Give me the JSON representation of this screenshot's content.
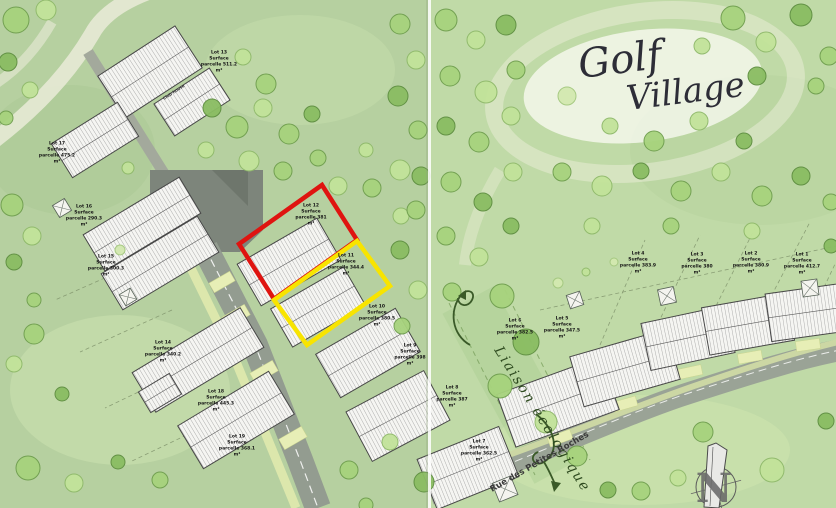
{
  "title": {
    "word1": "Golf",
    "word2": "Village"
  },
  "labels": {
    "street": "Rue des Petites Roches",
    "eco_corridor": "Liaison écologique",
    "compass": "N",
    "club": "Club house"
  },
  "highlights": {
    "red": "#df1410",
    "yellow": "#f8e400"
  },
  "lots": [
    {
      "id": "lot-12",
      "x": 311,
      "y": 215,
      "highlight": "red",
      "label": "Lot 12\nSurface\nparcelle 381\nm²"
    },
    {
      "id": "lot-11",
      "x": 346,
      "y": 265,
      "highlight": "yellow",
      "label": "Lot 11\nSurface\nparcelle 344.4\nm²"
    },
    {
      "id": "lot-10",
      "x": 377,
      "y": 316,
      "highlight": "none",
      "label": "Lot 10\nSurface\nparcelle 380.5\nm²"
    },
    {
      "id": "lot-13",
      "x": 219,
      "y": 62,
      "highlight": "none",
      "label": "Lot 13\nSurface\nparcelle 511.2\nm²"
    },
    {
      "id": "lot-17",
      "x": 57,
      "y": 153,
      "highlight": "none",
      "label": "Lot 17\nSurface\nparcelle 475.2\nm²"
    },
    {
      "id": "lot-16",
      "x": 84,
      "y": 216,
      "highlight": "none",
      "label": "Lot 16\nSurface\nparcelle 290.3\nm²"
    },
    {
      "id": "lot-15",
      "x": 106,
      "y": 266,
      "highlight": "none",
      "label": "Lot 15\nSurface\nparcelle 300.3\nm²"
    },
    {
      "id": "lot-14",
      "x": 163,
      "y": 352,
      "highlight": "none",
      "label": "Lot 14\nSurface\nparcelle 340.2\nm²"
    },
    {
      "id": "lot-18",
      "x": 216,
      "y": 401,
      "highlight": "none",
      "label": "Lot 18\nSurface\nparcelle 445.3\nm²"
    },
    {
      "id": "lot-19",
      "x": 237,
      "y": 446,
      "highlight": "none",
      "label": "Lot 19\nSurface\nparcelle 368.1\nm²"
    },
    {
      "id": "lot-9",
      "x": 410,
      "y": 355,
      "highlight": "none",
      "label": "Lot 9\nSurface\nparcelle 398\nm²"
    },
    {
      "id": "lot-8",
      "x": 452,
      "y": 397,
      "highlight": "none",
      "label": "Lot 8\nSurface\nparcelle 387\nm²"
    },
    {
      "id": "lot-7",
      "x": 479,
      "y": 451,
      "highlight": "none",
      "label": "Lot 7\nSurface\nparcelle 362.5\nm²"
    },
    {
      "id": "lot-6",
      "x": 515,
      "y": 330,
      "highlight": "none",
      "label": "Lot 6\nSurface\nparcelle 382.5\nm²"
    },
    {
      "id": "lot-5",
      "x": 562,
      "y": 328,
      "highlight": "none",
      "label": "Lot 5\nSurface\nparcelle 347.5\nm²"
    },
    {
      "id": "lot-4",
      "x": 638,
      "y": 263,
      "highlight": "none",
      "label": "Lot 4\nSurface\nparcelle 383.9\nm²"
    },
    {
      "id": "lot-3",
      "x": 697,
      "y": 264,
      "highlight": "none",
      "label": "Lot 3\nSurface\nparcelle 380\nm²"
    },
    {
      "id": "lot-2",
      "x": 751,
      "y": 263,
      "highlight": "none",
      "label": "Lot 2\nSurface\nparcelle 380.9\nm²"
    },
    {
      "id": "lot-1",
      "x": 802,
      "y": 264,
      "highlight": "none",
      "label": "Lot 1\nSurface\nparcelle 412.7\nm²"
    }
  ],
  "map": {
    "trees": [
      [
        16,
        20,
        13,
        0
      ],
      [
        46,
        10,
        10,
        1
      ],
      [
        8,
        62,
        9,
        2
      ],
      [
        30,
        90,
        8,
        1
      ],
      [
        6,
        118,
        7,
        0
      ],
      [
        12,
        205,
        11,
        0
      ],
      [
        32,
        236,
        9,
        1
      ],
      [
        14,
        262,
        8,
        2
      ],
      [
        34,
        300,
        7,
        0
      ],
      [
        34,
        334,
        10,
        0
      ],
      [
        14,
        364,
        8,
        1
      ],
      [
        62,
        394,
        7,
        2
      ],
      [
        28,
        468,
        12,
        0
      ],
      [
        74,
        483,
        9,
        1
      ],
      [
        118,
        462,
        7,
        2
      ],
      [
        160,
        480,
        8,
        0
      ],
      [
        243,
        57,
        8,
        1
      ],
      [
        266,
        84,
        10,
        0
      ],
      [
        212,
        108,
        9,
        2
      ],
      [
        237,
        127,
        11,
        0
      ],
      [
        263,
        108,
        9,
        1
      ],
      [
        289,
        134,
        10,
        0
      ],
      [
        312,
        114,
        8,
        2
      ],
      [
        249,
        161,
        10,
        1
      ],
      [
        283,
        171,
        9,
        0
      ],
      [
        206,
        150,
        8,
        1
      ],
      [
        318,
        158,
        8,
        0
      ],
      [
        338,
        186,
        9,
        1
      ],
      [
        372,
        188,
        9,
        0
      ],
      [
        401,
        216,
        8,
        1
      ],
      [
        421,
        176,
        9,
        2
      ],
      [
        366,
        150,
        7,
        1
      ],
      [
        400,
        24,
        10,
        0
      ],
      [
        416,
        60,
        9,
        1
      ],
      [
        398,
        96,
        10,
        2
      ],
      [
        418,
        130,
        9,
        0
      ],
      [
        400,
        170,
        10,
        1
      ],
      [
        416,
        210,
        9,
        0
      ],
      [
        400,
        250,
        9,
        2
      ],
      [
        418,
        290,
        9,
        1
      ],
      [
        402,
        326,
        8,
        0
      ],
      [
        446,
        20,
        11,
        0
      ],
      [
        476,
        40,
        9,
        1
      ],
      [
        506,
        25,
        10,
        2
      ],
      [
        450,
        76,
        10,
        0
      ],
      [
        486,
        92,
        11,
        1
      ],
      [
        516,
        70,
        9,
        0
      ],
      [
        446,
        126,
        9,
        2
      ],
      [
        479,
        142,
        10,
        0
      ],
      [
        511,
        116,
        9,
        1
      ],
      [
        451,
        182,
        10,
        0
      ],
      [
        483,
        202,
        9,
        2
      ],
      [
        513,
        172,
        9,
        1
      ],
      [
        446,
        236,
        9,
        0
      ],
      [
        479,
        257,
        9,
        1
      ],
      [
        511,
        226,
        8,
        2
      ],
      [
        452,
        292,
        9,
        0
      ],
      [
        502,
        296,
        12,
        0
      ],
      [
        526,
        342,
        13,
        2
      ],
      [
        500,
        386,
        12,
        0
      ],
      [
        546,
        422,
        11,
        1
      ],
      [
        577,
        456,
        10,
        0
      ],
      [
        733,
        18,
        12,
        0
      ],
      [
        766,
        42,
        10,
        1
      ],
      [
        801,
        15,
        11,
        2
      ],
      [
        829,
        56,
        9,
        0
      ],
      [
        702,
        46,
        8,
        1
      ],
      [
        757,
        76,
        9,
        2
      ],
      [
        816,
        86,
        8,
        0
      ],
      [
        567,
        96,
        9,
        3
      ],
      [
        610,
        126,
        8,
        1
      ],
      [
        654,
        141,
        10,
        0
      ],
      [
        699,
        121,
        9,
        1
      ],
      [
        744,
        141,
        8,
        2
      ],
      [
        562,
        172,
        9,
        0
      ],
      [
        602,
        186,
        10,
        1
      ],
      [
        641,
        171,
        8,
        2
      ],
      [
        681,
        191,
        10,
        0
      ],
      [
        721,
        172,
        9,
        1
      ],
      [
        762,
        196,
        10,
        0
      ],
      [
        801,
        176,
        9,
        2
      ],
      [
        831,
        202,
        8,
        0
      ],
      [
        592,
        226,
        8,
        1
      ],
      [
        671,
        226,
        8,
        0
      ],
      [
        752,
        231,
        8,
        1
      ],
      [
        831,
        246,
        7,
        2
      ],
      [
        703,
        432,
        10,
        0
      ],
      [
        772,
        470,
        12,
        1
      ],
      [
        641,
        491,
        9,
        0
      ],
      [
        826,
        421,
        8,
        2
      ],
      [
        678,
        478,
        8,
        1
      ],
      [
        608,
        490,
        8,
        2
      ],
      [
        349,
        470,
        9,
        0
      ],
      [
        390,
        442,
        8,
        1
      ],
      [
        424,
        482,
        10,
        2
      ],
      [
        366,
        505,
        7,
        0
      ],
      [
        558,
        283,
        5,
        3
      ],
      [
        586,
        272,
        4,
        1
      ],
      [
        614,
        262,
        4,
        3
      ],
      [
        120,
        250,
        5,
        3
      ],
      [
        128,
        168,
        6,
        1
      ]
    ],
    "buildings": [
      [
        150,
        72,
        92,
        50,
        -33
      ],
      [
        192,
        102,
        66,
        38,
        -33
      ],
      [
        95,
        140,
        78,
        40,
        -32
      ],
      [
        142,
        224,
        112,
        42,
        -31
      ],
      [
        160,
        263,
        112,
        42,
        -31
      ],
      [
        289,
        262,
        92,
        48,
        -30
      ],
      [
        318,
        307,
        84,
        44,
        -30
      ],
      [
        368,
        353,
        92,
        50,
        -30
      ],
      [
        398,
        416,
        88,
        56,
        -28
      ],
      [
        198,
        360,
        126,
        46,
        -31
      ],
      [
        236,
        420,
        106,
        50,
        -31
      ],
      [
        160,
        393,
        36,
        24,
        -31
      ],
      [
        468,
        468,
        88,
        54,
        -22
      ],
      [
        558,
        402,
        110,
        56,
        -20
      ],
      [
        625,
        368,
        100,
        52,
        -16
      ],
      [
        688,
        338,
        86,
        48,
        -12
      ],
      [
        748,
        324,
        86,
        48,
        -10
      ],
      [
        810,
        312,
        84,
        48,
        -8
      ]
    ],
    "driveways": [
      [
        222,
        282,
        24,
        11,
        -30
      ],
      [
        236,
        316,
        26,
        12,
        -30
      ],
      [
        264,
        372,
        26,
        12,
        -30
      ],
      [
        293,
        438,
        26,
        12,
        -30
      ],
      [
        560,
        438,
        24,
        10,
        -20
      ],
      [
        625,
        404,
        24,
        10,
        -16
      ],
      [
        690,
        372,
        24,
        10,
        -12
      ],
      [
        750,
        357,
        24,
        10,
        -10
      ],
      [
        808,
        345,
        24,
        10,
        -8
      ]
    ],
    "sheds": [
      [
        667,
        296,
        16,
        -12
      ],
      [
        810,
        288,
        16,
        -8
      ],
      [
        62,
        208,
        14,
        -31
      ],
      [
        128,
        297,
        13,
        -31
      ],
      [
        505,
        489,
        20,
        -22
      ],
      [
        575,
        300,
        14,
        -18
      ]
    ],
    "boundaries": [
      [
        150,
        258,
        55,
        300
      ],
      [
        172,
        310,
        80,
        352
      ],
      [
        195,
        365,
        105,
        408
      ],
      [
        218,
        420,
        130,
        462
      ],
      [
        600,
        345,
        645,
        240
      ],
      [
        655,
        330,
        700,
        235
      ],
      [
        710,
        318,
        755,
        228
      ],
      [
        765,
        308,
        810,
        222
      ],
      [
        818,
        300,
        836,
        262
      ],
      [
        540,
        310,
        836,
        246
      ]
    ]
  }
}
